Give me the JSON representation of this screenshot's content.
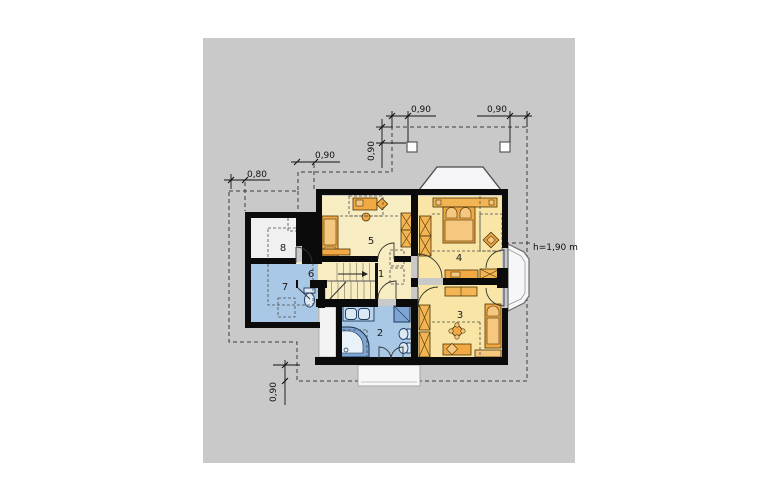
{
  "page": {
    "background": "#ffffff",
    "canvas_color": "#c9c9c9"
  },
  "plan": {
    "rooms": [
      {
        "label": "1"
      },
      {
        "label": "2"
      },
      {
        "label": "3"
      },
      {
        "label": "4"
      },
      {
        "label": "5"
      },
      {
        "label": "6"
      },
      {
        "label": "7"
      },
      {
        "label": "8"
      }
    ],
    "dimensions": {
      "overhang_left": "0,80",
      "eave_step_left": "0,90",
      "roof_edge_vertical": "0,90",
      "skylight_left": "0,90",
      "skylight_right": "0,90",
      "overhang_bottom": "0,90",
      "knee_wall_height": "h=1,90 m"
    },
    "colors": {
      "wall": "#0b0b0b",
      "room_yellow": "#f9e6a6",
      "room_cream": "#f8ecc2",
      "room_blue": "#a8c8e6",
      "room_gray": "#f0f0f0",
      "furniture_orange": "#f2a843",
      "furniture_light": "#f6c77e",
      "wardrobe_fill": "#f3b553",
      "fixture_blue": "#7fa6d2",
      "dash": "#3c3c3c"
    }
  }
}
